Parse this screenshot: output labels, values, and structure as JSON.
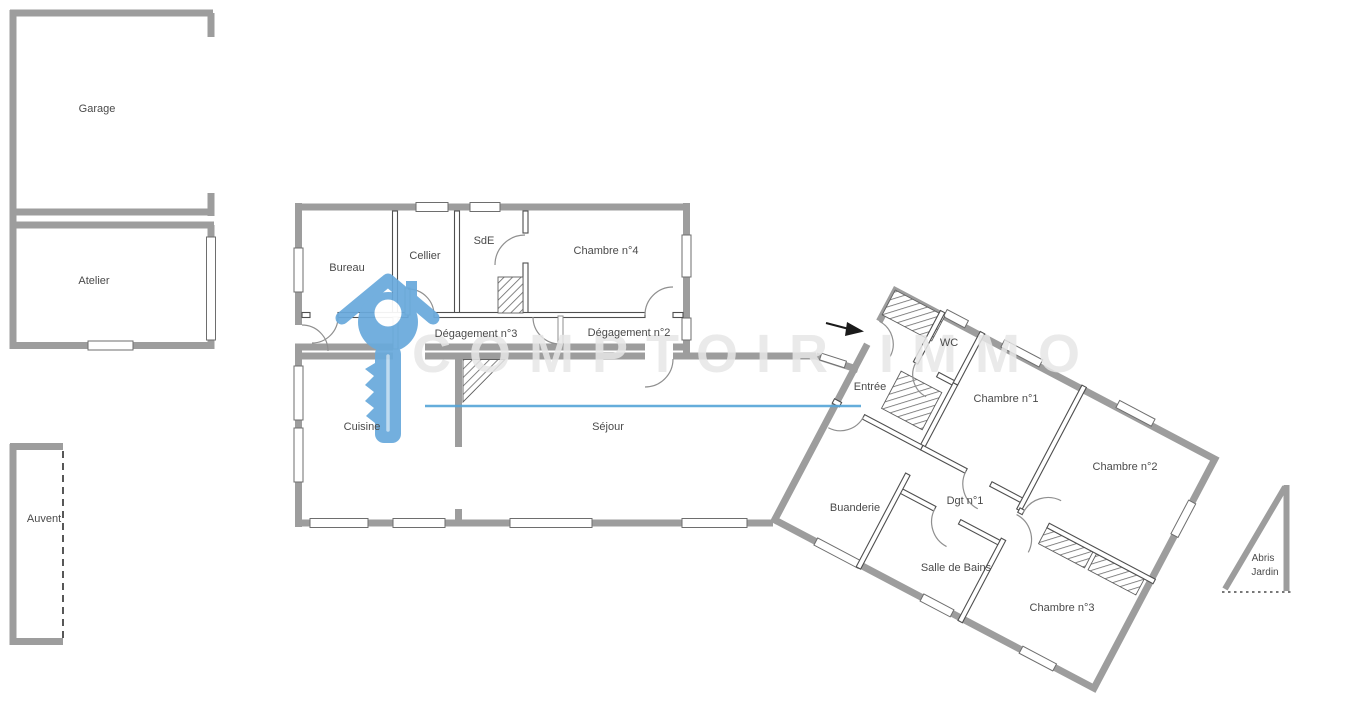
{
  "rooms": {
    "garage": "Garage",
    "atelier": "Atelier",
    "auvent": "Auvent",
    "bureau": "Bureau",
    "cellier": "Cellier",
    "sde": "SdE",
    "chambre4": "Chambre n°4",
    "degagement3": "Dégagement n°3",
    "degagement2": "Dégagement n°2",
    "cuisine": "Cuisine",
    "sejour": "Séjour",
    "entree": "Entrée",
    "wc": "WC",
    "chambre1": "Chambre n°1",
    "chambre2": "Chambre n°2",
    "buanderie": "Buanderie",
    "dgt1": "Dgt n°1",
    "salle_de_bains": "Salle de Bains",
    "chambre3": "Chambre n°3",
    "abris": "Abris",
    "jardin": "Jardin"
  },
  "watermark": {
    "brand_text": "COMPTOIR IMMO",
    "logo": "key-house-logo"
  },
  "colors": {
    "wall": "#9d9d9d",
    "partition": "#4f4f4f",
    "door": "#8f8f8f",
    "label": "#4a4a4a",
    "watermark_blue": "#69aadc",
    "watermark_line": "#55a5d8",
    "watermark_text": "#e7e7e7",
    "arrow": "#1a1a1a"
  }
}
